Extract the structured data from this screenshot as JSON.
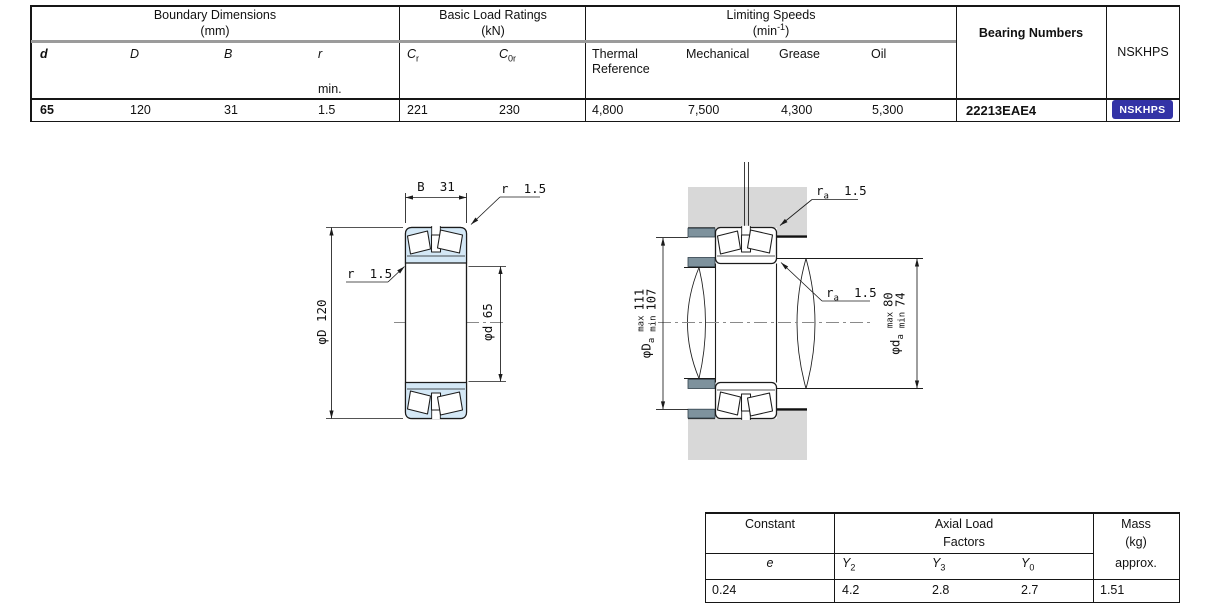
{
  "colors": {
    "badge_bg": "#3333a6",
    "drawing_blue": "#d4e8f6",
    "housing_gray": "#d8d8d8",
    "shoulder_slate": "#7e929d"
  },
  "spec_table": {
    "boundary": {
      "title": "Boundary Dimensions",
      "unit": "(mm)",
      "cols": {
        "d": {
          "label": "d",
          "value": "65"
        },
        "D": {
          "label": "D",
          "value": "120"
        },
        "B": {
          "label": "B",
          "value": "31"
        },
        "r": {
          "label": "r",
          "note": "min.",
          "value": "1.5"
        }
      }
    },
    "load_ratings": {
      "title": "Basic Load Ratings",
      "unit": "(kN)",
      "cols": {
        "cr": {
          "sym": "C",
          "sub": "r",
          "value": "221"
        },
        "c0r": {
          "sym": "C",
          "sub": "0r",
          "value": "230"
        }
      }
    },
    "limiting_speeds": {
      "title": "Limiting Speeds",
      "unit_open": "(min",
      "unit_sup": "-1",
      "unit_close": ")",
      "cols": {
        "thermal": {
          "label": "Thermal\nReference",
          "value": "4,800"
        },
        "mechanical": {
          "label": "Mechanical",
          "value": "7,500"
        },
        "grease": {
          "label": "Grease",
          "value": "4,300"
        },
        "oil": {
          "label": "Oil",
          "value": "5,300"
        }
      }
    },
    "bearing_numbers": {
      "title": "Bearing Numbers",
      "value": "22213EAE4"
    },
    "nskhps": {
      "title": "NSKHPS",
      "badge": "NSKHPS"
    }
  },
  "factor_table": {
    "constant": {
      "title": "Constant",
      "sub": "e",
      "value": "0.24"
    },
    "axial": {
      "title_line1": "Axial Load",
      "title_line2": "Factors",
      "cols": {
        "y2": {
          "sym": "Y",
          "sub": "2",
          "value": "4.2"
        },
        "y3": {
          "sym": "Y",
          "sub": "3",
          "value": "2.8"
        },
        "y0": {
          "sym": "Y",
          "sub": "0",
          "value": "2.7"
        }
      }
    },
    "mass": {
      "line1": "Mass",
      "line2": "(kg)",
      "line3": "approx.",
      "value": "1.51"
    }
  },
  "drawings": {
    "section": {
      "dim_width": "B  31",
      "dim_chamfer_top": "r  1.5",
      "dim_chamfer_side": "r  1.5",
      "dim_outer_dia": "φD 120",
      "dim_bore_dia": "φd 65"
    },
    "mount": {
      "fillet_top": {
        "sym": "r",
        "sub": "a",
        "value": "1.5"
      },
      "fillet_mid": {
        "sym": "r",
        "sub": "a",
        "value": "1.5"
      },
      "housing_abutment": {
        "sym": "φD",
        "sub": "a",
        "max_label": "max",
        "max_value": "111",
        "min_label": "min",
        "min_value": "107"
      },
      "shaft_abutment": {
        "sym": "φd",
        "sub": "a",
        "max_label": "max",
        "max_value": "80",
        "min_label": "min",
        "min_value": "74"
      }
    }
  }
}
